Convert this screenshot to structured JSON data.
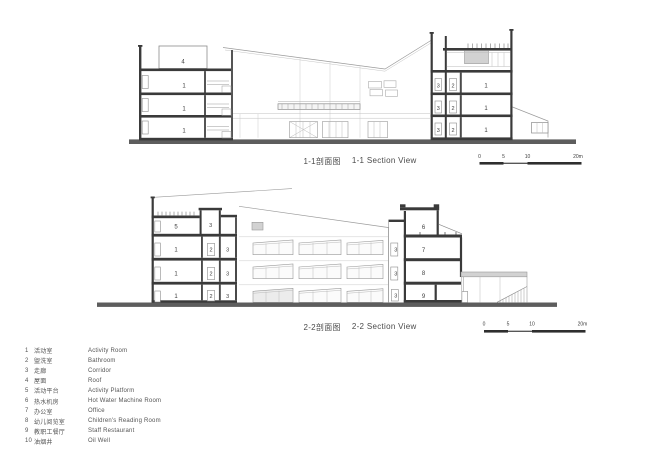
{
  "drawing": {
    "background": "#ffffff",
    "line_color": "#9a9a9a",
    "cut_color": "#3a3a3a",
    "ground_color": "#5d5d5d",
    "hatch_fill": "#d2d2d2",
    "text_color": "#4a4a4a"
  },
  "s1": {
    "title_zh": "1-1剖面图",
    "title_en": "1-1 Section View",
    "labels": {
      "roof": "4",
      "left_rooms": [
        "1",
        "1",
        "1"
      ],
      "corridor": [
        "3",
        "3",
        "3"
      ],
      "bath": [
        "2",
        "2",
        "2"
      ],
      "right_rooms": [
        "1",
        "1",
        "1"
      ]
    }
  },
  "s2": {
    "title_zh": "2-2剖面图",
    "title_en": "2-2 Section View",
    "labels": {
      "platform": "5",
      "top_corridor": "3",
      "left_rooms": [
        "1",
        "1",
        "1"
      ],
      "bath": [
        "2",
        "2",
        "2"
      ],
      "left_corridor": [
        "3",
        "3",
        "3"
      ],
      "right_corridor": [
        "3",
        "3",
        "3"
      ],
      "hot_water_room": "6",
      "office": "7",
      "reading_room": "8",
      "restaurant": "9"
    }
  },
  "scalebar": {
    "ticks": [
      "0",
      "5",
      "10",
      "20m"
    ]
  },
  "legend": {
    "items": [
      {
        "num": "1",
        "zh": "活动室",
        "en": "Activity Room"
      },
      {
        "num": "2",
        "zh": "盥洗室",
        "en": "Bathroom"
      },
      {
        "num": "3",
        "zh": "走廊",
        "en": "Corridor"
      },
      {
        "num": "4",
        "zh": "屋面",
        "en": "Roof"
      },
      {
        "num": "5",
        "zh": "活动平台",
        "en": "Activity Platform"
      },
      {
        "num": "6",
        "zh": "热水机房",
        "en": "Hot Water Machine Room"
      },
      {
        "num": "7",
        "zh": "办公室",
        "en": "Office"
      },
      {
        "num": "8",
        "zh": "幼儿阅览室",
        "en": "Children's Reading Room"
      },
      {
        "num": "9",
        "zh": "教职工餐厅",
        "en": "Staff Restaurant"
      },
      {
        "num": "10",
        "zh": "油烟井",
        "en": "Oil Well"
      }
    ]
  }
}
